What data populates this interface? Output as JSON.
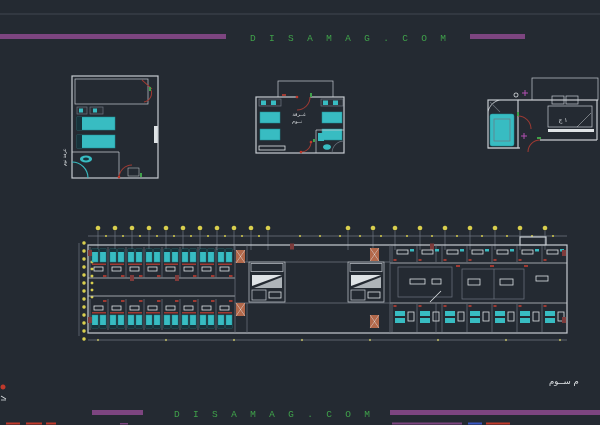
{
  "meta": {
    "width": 600,
    "height": 425,
    "app": "cad-drawing-viewer"
  },
  "colors": {
    "background": "#242a32",
    "rule": "#3f4750",
    "wall": "#c6cbd0",
    "dim": "#6e7680",
    "cyan": "#38bcc2",
    "cyandark": "#1d8f96",
    "darkband": "#17333b",
    "yellow": "#d9cf4e",
    "purple": "#7d4580",
    "green": "#3fa04a",
    "red": "#a03a32",
    "redbright": "#c0392b",
    "redwall": "#7e3b3b",
    "orange": "#b2684a",
    "white": "#dfe3e6",
    "magenta": "#b24fb2",
    "blue": "#3a57c2",
    "bedfill": "#3a424a"
  },
  "header": {
    "watermark": "DISAMAG.COM"
  },
  "footer": {
    "watermark": "DISAMAG.COM",
    "floor_title": "م ســوم"
  },
  "labels": {
    "plan_left_side": "غرفة نوم",
    "plan_mid_line1": "غــرفة",
    "plan_mid_line2": "نــوم",
    "plan_right": "١ ج"
  },
  "icons": {
    "grid_bubble": "yellow-dot",
    "door_swing": "red-arc",
    "hinge": "green-tick"
  },
  "drawing": {
    "dots": {
      "top_main": {
        "axis": "row",
        "fixed": 228,
        "r": 2.3,
        "tick_to": 250,
        "xs": [
          98,
          115,
          132,
          149,
          166,
          183,
          200,
          217,
          234,
          251,
          268,
          348,
          373,
          395,
          420,
          445,
          470,
          495,
          520,
          545
        ]
      },
      "top_minor": {
        "axis": "row",
        "fixed": 236,
        "r": 1.0,
        "xs": [
          106,
          123,
          140,
          157,
          174,
          191,
          208,
          225,
          242,
          259,
          300,
          320,
          340,
          360,
          381,
          407,
          432,
          457,
          482,
          507,
          532,
          553
        ]
      },
      "left_a": {
        "axis": "col",
        "fixed": 84,
        "r": 1.7,
        "xs": [
          243,
          251,
          259,
          267,
          275,
          283,
          291,
          299,
          307,
          315,
          323,
          331,
          339
        ]
      },
      "left_b": {
        "axis": "col",
        "fixed": 92,
        "r": 1.4,
        "xs": [
          262,
          269,
          276,
          283,
          290,
          297
        ]
      },
      "bottom_minor": {
        "axis": "row",
        "fixed": 340,
        "r": 1.1,
        "xs": [
          98,
          166,
          234,
          302,
          370,
          438,
          506,
          560
        ]
      }
    },
    "repeats": {
      "left_top_rooms": {
        "symbol": "#symBedT",
        "name": "hotel-room-top",
        "positions": [
          [
            90,
            247
          ],
          [
            108,
            247
          ],
          [
            126,
            247
          ],
          [
            144,
            247
          ],
          [
            162,
            247
          ],
          [
            180,
            247
          ],
          [
            198,
            247
          ],
          [
            216,
            247
          ]
        ]
      },
      "left_bottom_rooms": {
        "symbol": "#symBedB",
        "name": "hotel-room-bottom",
        "positions": [
          [
            90,
            299
          ],
          [
            108,
            299
          ],
          [
            126,
            299
          ],
          [
            144,
            299
          ],
          [
            162,
            299
          ],
          [
            180,
            299
          ],
          [
            198,
            299
          ],
          [
            216,
            299
          ]
        ]
      },
      "right_top_rooms": {
        "symbol": "#symRoomT",
        "name": "office-room-top",
        "positions": [
          [
            392,
            246
          ],
          [
            417,
            246
          ],
          [
            442,
            246
          ],
          [
            467,
            246
          ],
          [
            492,
            246
          ],
          [
            517,
            246
          ],
          [
            542,
            246
          ]
        ]
      },
      "right_bottom_rooms": {
        "symbol": "#symRoomB",
        "name": "hotel-room-bottom-right",
        "positions": [
          [
            392,
            304
          ],
          [
            417,
            304
          ],
          [
            442,
            304
          ],
          [
            467,
            304
          ],
          [
            492,
            304
          ],
          [
            517,
            304
          ],
          [
            542,
            304
          ]
        ]
      },
      "stair_cores": {
        "symbol": "#symStair",
        "name": "stair-core",
        "positions": [
          [
            249,
            262
          ],
          [
            348,
            262
          ]
        ]
      },
      "orange_columns": {
        "symbol": "#symColumn",
        "name": "column-block",
        "positions": [
          [
            236,
            250
          ],
          [
            236,
            303
          ],
          [
            370,
            248
          ],
          [
            370,
            315
          ]
        ]
      },
      "wall_fills": {
        "symbol": "#symWallFill",
        "name": "wall-fill-block",
        "positions": [
          [
            130,
            275
          ],
          [
            175,
            275
          ],
          [
            290,
            243.5
          ],
          [
            430,
            243.5
          ],
          [
            88,
            250
          ],
          [
            88,
            317
          ],
          [
            562,
            250
          ],
          [
            562,
            317
          ]
        ]
      }
    }
  }
}
